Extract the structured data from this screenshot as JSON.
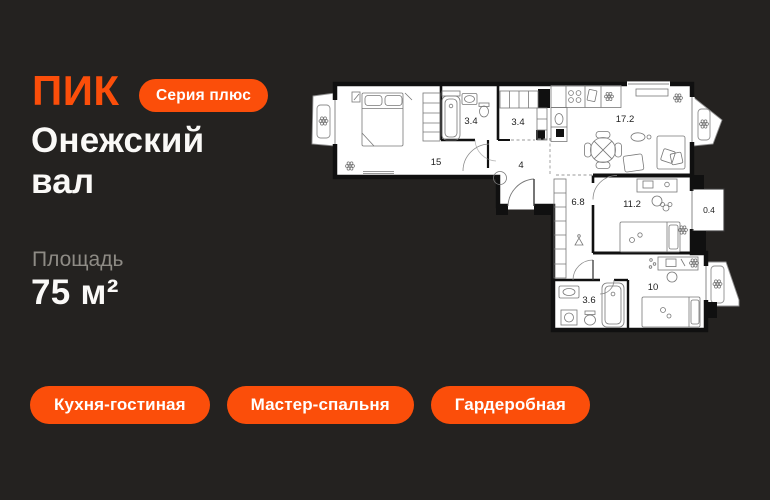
{
  "brand": {
    "logo": "ПИК",
    "series_badge": "Серия плюс"
  },
  "project": {
    "title_line1": "Онежский",
    "title_line2": "вал"
  },
  "area": {
    "label": "Площадь",
    "value": "75 м²"
  },
  "tags": [
    {
      "label": "Кухня-гостиная"
    },
    {
      "label": "Мастер-спальня"
    },
    {
      "label": "Гардеробная"
    }
  ],
  "floorplan": {
    "total_area_m2": "75",
    "rooms": [
      {
        "name": "master-bedroom",
        "area": "15"
      },
      {
        "name": "bathroom-1",
        "area": "3.4"
      },
      {
        "name": "wardrobe-room",
        "area": "3.4"
      },
      {
        "name": "kitchen-living-room",
        "area": "17.2"
      },
      {
        "name": "hallway",
        "area": "4"
      },
      {
        "name": "corridor",
        "area": "6.8"
      },
      {
        "name": "bedroom-2",
        "area": "11.2"
      },
      {
        "name": "balcony",
        "area": "0.4"
      },
      {
        "name": "bathroom-2",
        "area": "3.6"
      },
      {
        "name": "bedroom-3",
        "area": "10"
      }
    ]
  },
  "colors": {
    "accent": "#FB4E0A",
    "background": "#242220",
    "plan_paper": "#FFFFFF",
    "plan_wall": "#101010",
    "title_text": "#FAF9F7",
    "muted_text": "#8E8B85"
  }
}
